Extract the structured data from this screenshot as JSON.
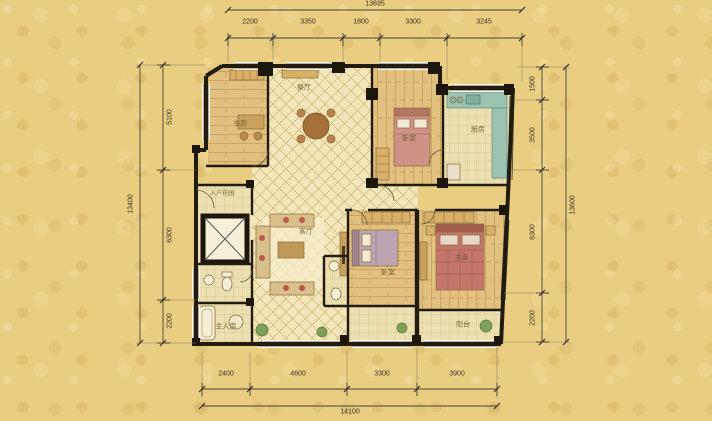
{
  "canvas": {
    "width": 712,
    "height": 421
  },
  "colors": {
    "background": "#e9cd80",
    "room_fill": "#f1e5bb",
    "wall": "#221b10",
    "tile_line": "#c9ab66",
    "kitchen_counter": "#9cc2b0",
    "bed_pink": "#cf9286",
    "bed_red": "#c4766a",
    "wood": "#e2c07f",
    "dimension_text": "#3a3328",
    "room_text": "#6b5832"
  },
  "dimensions": {
    "top": {
      "total": "13695",
      "segments": [
        "2200",
        "3350",
        "1800",
        "3300",
        "3245"
      ]
    },
    "bottom": {
      "total": "14100",
      "segments": [
        "2400",
        "4600",
        "3300",
        "3900"
      ]
    },
    "left": {
      "total": "13400",
      "segments": [
        "5100",
        "6300",
        "2200"
      ]
    },
    "right": {
      "total": "13600",
      "segments": [
        "1500",
        "3500",
        "6300",
        "2200"
      ]
    }
  },
  "rooms": {
    "entry_garden": "入户花园",
    "study": "书房",
    "dining": "餐厅",
    "bedroom_top": "卧室",
    "kitchen": "厨房",
    "living": "客厅",
    "bedroom_mid": "卧室",
    "master_bedroom": "主卧",
    "room_bottom_left": "主人房",
    "balcony": "阳台"
  }
}
